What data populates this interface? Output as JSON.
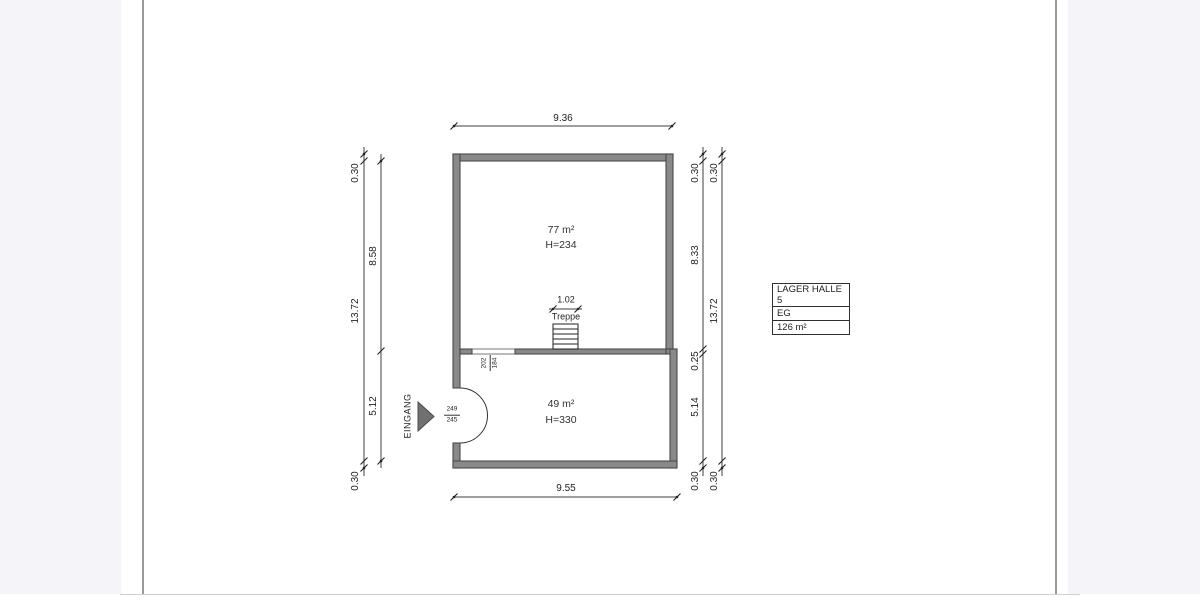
{
  "page": {
    "background_color": "#ffffff",
    "margin_band_color": "#f5f5f9",
    "page_edge_color": "#9a9a9a"
  },
  "plan": {
    "rooms": [
      {
        "area": "77 m²",
        "clear_height": "H=234"
      },
      {
        "area": "49 m²",
        "clear_height": "H=330"
      }
    ],
    "stairs_label": "Treppe",
    "entrance_label": "EINGANG",
    "dims": {
      "top_width": "9.36",
      "bottom_width": "9.55",
      "stairs_width": "1.02",
      "left_outer_wall_top": "0.30",
      "left_outer_total": "13.72",
      "left_outer_wall_bottom": "0.30",
      "left_room_upper": "8.58",
      "left_room_lower": "5.12",
      "right_wall_top": "0.30",
      "right_room_upper": "8.33",
      "right_inner_wall": "0.25",
      "right_room_lower": "5.14",
      "right_wall_bottom": "0.30",
      "right_outer_wall_top": "0.30",
      "right_outer_total": "13.72",
      "right_outer_wall_bottom": "0.30"
    },
    "entrance_door_marks": {
      "top": "249",
      "bottom": "245"
    },
    "inner_door_marks": {
      "top": "202",
      "bottom": "184"
    },
    "colors": {
      "wall_fill": "#898989",
      "wall_outline": "#4b4b4b",
      "dimension_line": "#3f3f3f",
      "text": "#222222"
    }
  },
  "legend": {
    "rows": [
      "LAGER HALLE 5",
      "EG",
      "126 m²"
    ]
  }
}
